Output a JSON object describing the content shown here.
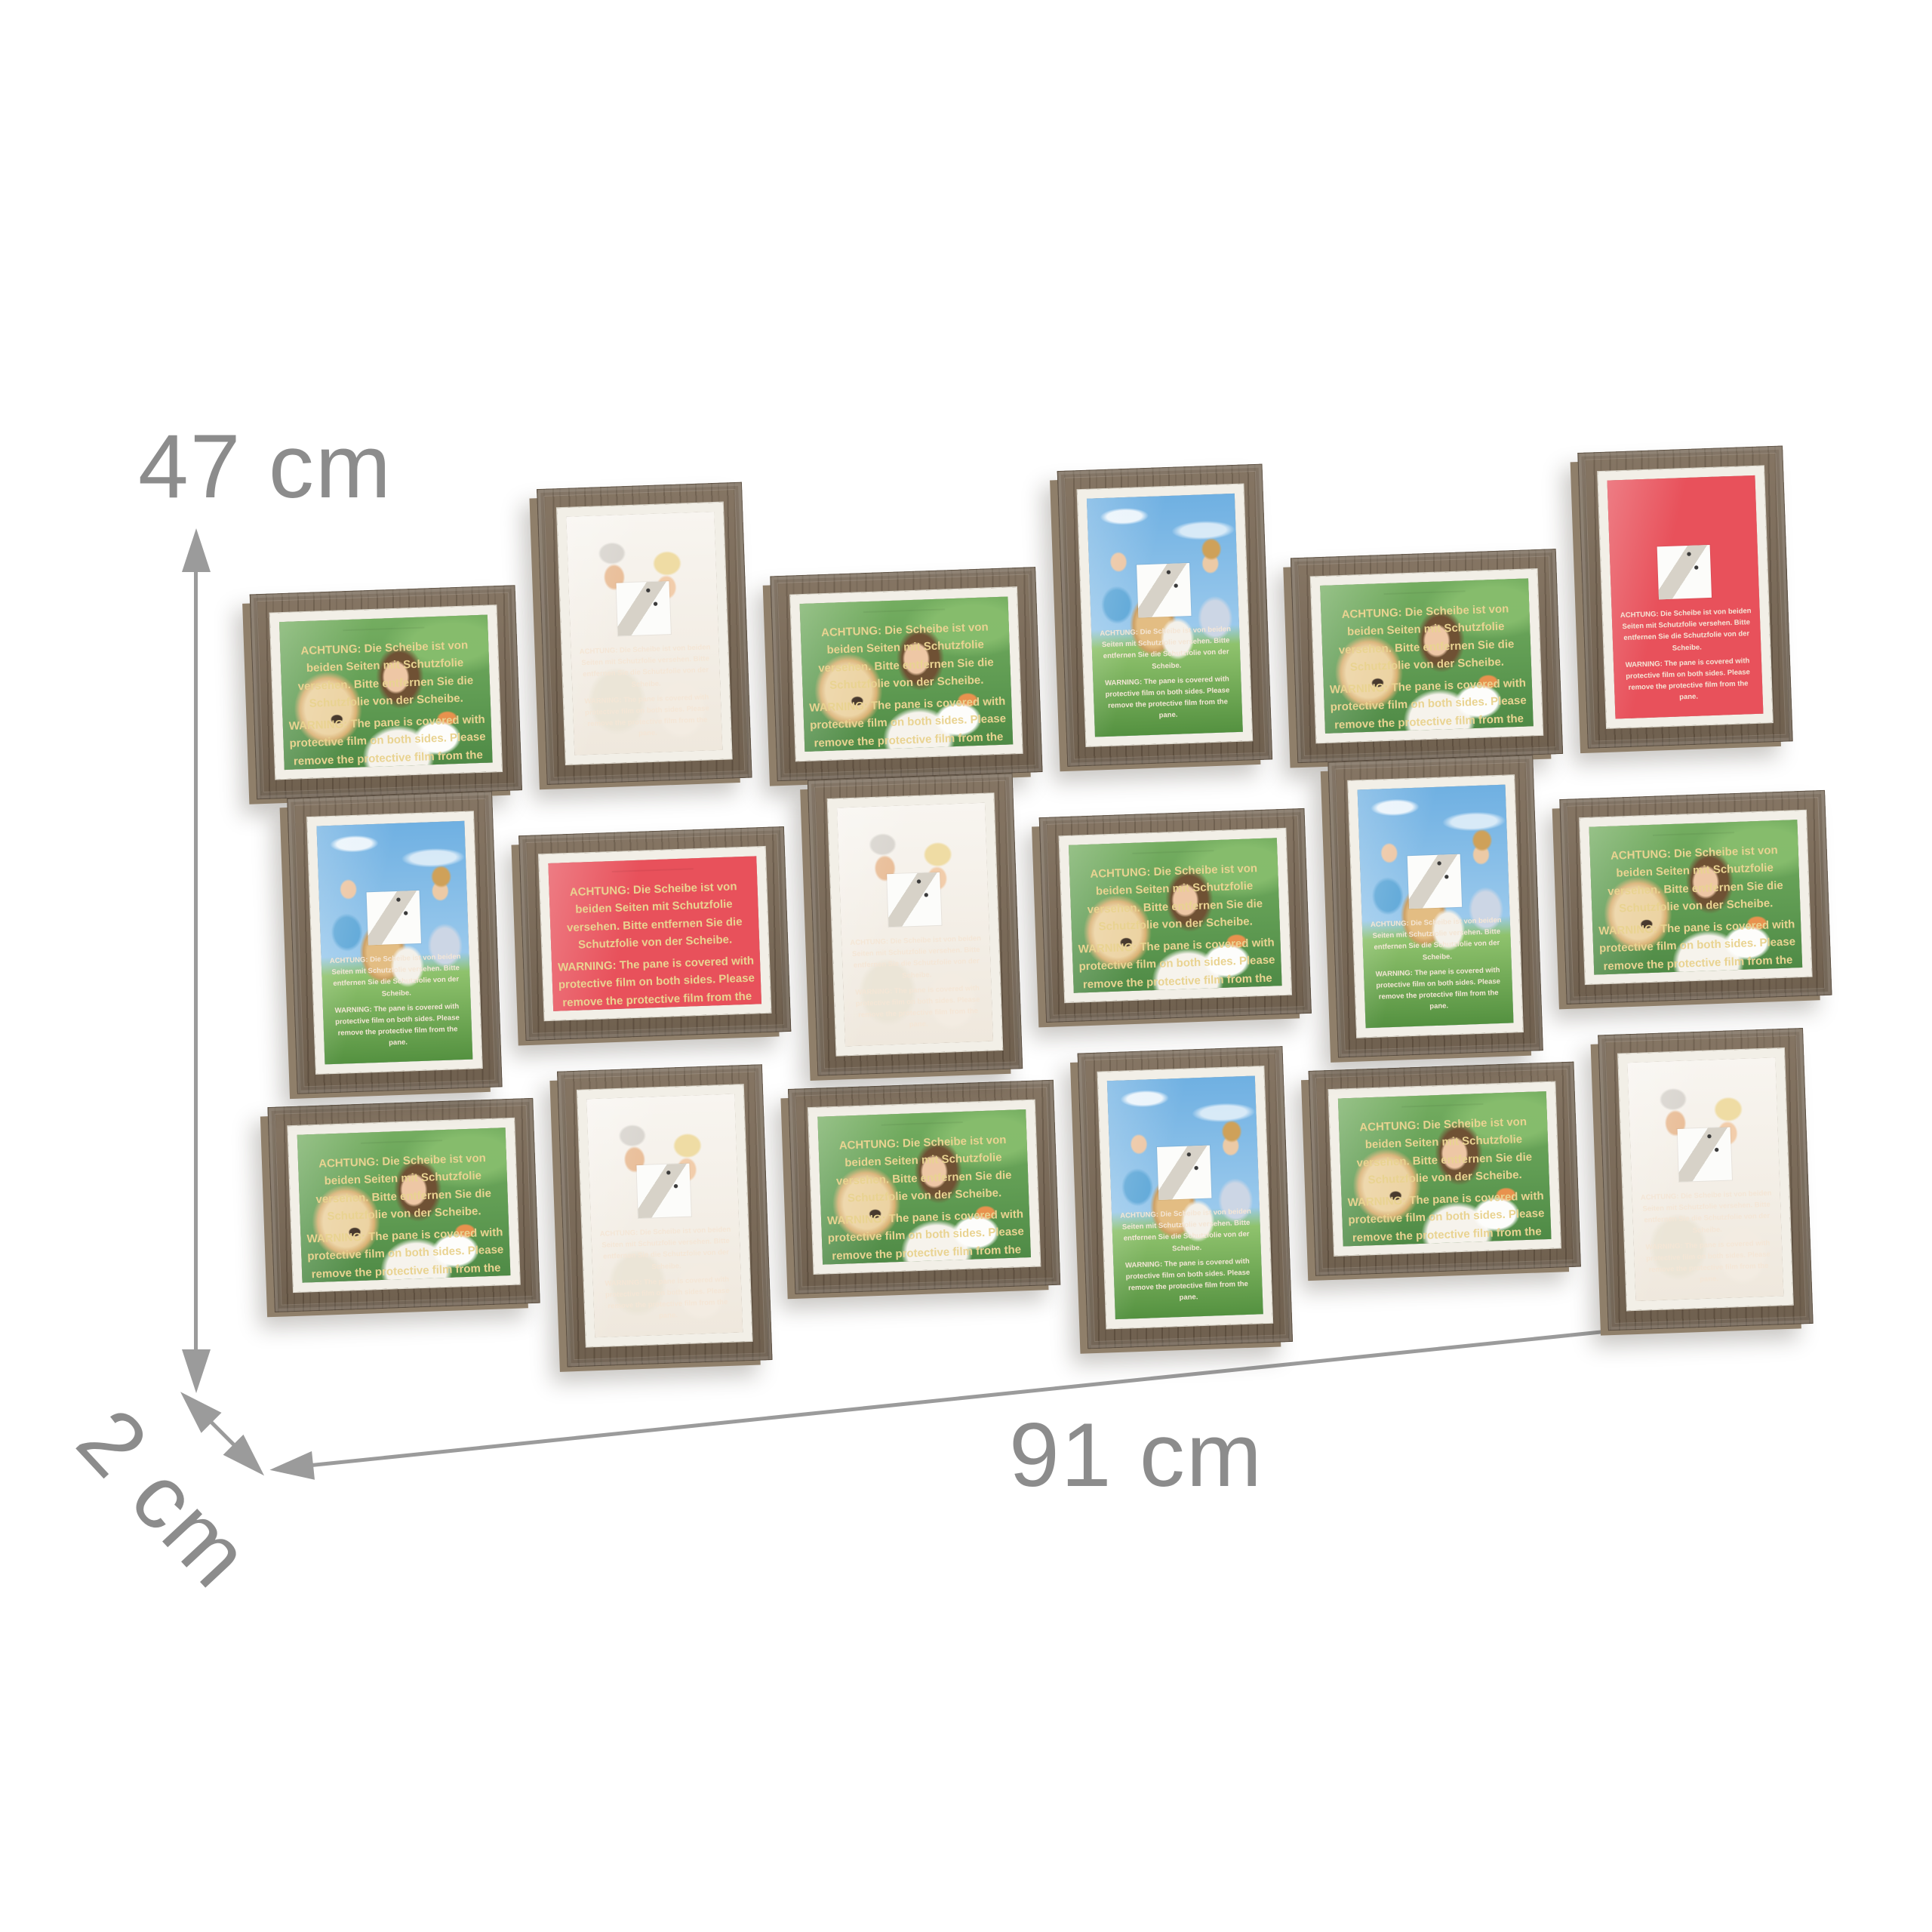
{
  "product": {
    "type": "collage-photo-frame-18",
    "frame_wood_color": "#7c6b58",
    "mat_color": "#f2efe7",
    "insert_red_color": "#e8515b",
    "background_color": "#ffffff"
  },
  "dimensions": {
    "height_label": "47 cm",
    "width_label": "91 cm",
    "depth_label": "2 cm",
    "label_color": "#8c8c8c",
    "arrow_color": "#9b9b9b"
  },
  "warning_insert": {
    "de": "ACHTUNG: Die Scheibe ist von beiden Seiten mit Schutzfolie versehen. Bitte entfernen Sie die Schutzfolie von der Scheibe.",
    "en": "WARNING: The pane is covered with protective film on both sides. Please remove the protective film from the pane."
  },
  "photos": {
    "pets": "woman with golden retriever and white-orange kitten on green meadow",
    "couple": "smiling elderly couple, gray-haired man and blonde woman, light background",
    "family": "mother, boy and girl with golden retriever and kitten, blue sky and grass",
    "red-insert": "red protective-film notice insert with white paper square"
  },
  "collage": {
    "rows": 3,
    "cols": 6,
    "frame_count": 18,
    "frames": [
      {
        "row": 1,
        "col": 1,
        "orientation": "landscape",
        "photo": "pets"
      },
      {
        "row": 1,
        "col": 2,
        "orientation": "portrait",
        "photo": "couple"
      },
      {
        "row": 1,
        "col": 3,
        "orientation": "landscape",
        "photo": "pets"
      },
      {
        "row": 1,
        "col": 4,
        "orientation": "portrait",
        "photo": "family"
      },
      {
        "row": 1,
        "col": 5,
        "orientation": "landscape",
        "photo": "pets"
      },
      {
        "row": 1,
        "col": 6,
        "orientation": "portrait",
        "photo": "red-insert"
      },
      {
        "row": 2,
        "col": 1,
        "orientation": "portrait",
        "photo": "family"
      },
      {
        "row": 2,
        "col": 2,
        "orientation": "landscape",
        "photo": "red-insert"
      },
      {
        "row": 2,
        "col": 3,
        "orientation": "portrait",
        "photo": "couple"
      },
      {
        "row": 2,
        "col": 4,
        "orientation": "landscape",
        "photo": "pets"
      },
      {
        "row": 2,
        "col": 5,
        "orientation": "portrait",
        "photo": "family"
      },
      {
        "row": 2,
        "col": 6,
        "orientation": "landscape",
        "photo": "pets"
      },
      {
        "row": 3,
        "col": 1,
        "orientation": "landscape",
        "photo": "pets"
      },
      {
        "row": 3,
        "col": 2,
        "orientation": "portrait",
        "photo": "couple"
      },
      {
        "row": 3,
        "col": 3,
        "orientation": "landscape",
        "photo": "pets"
      },
      {
        "row": 3,
        "col": 4,
        "orientation": "portrait",
        "photo": "family"
      },
      {
        "row": 3,
        "col": 5,
        "orientation": "landscape",
        "photo": "pets"
      },
      {
        "row": 3,
        "col": 6,
        "orientation": "portrait",
        "photo": "couple"
      }
    ]
  }
}
